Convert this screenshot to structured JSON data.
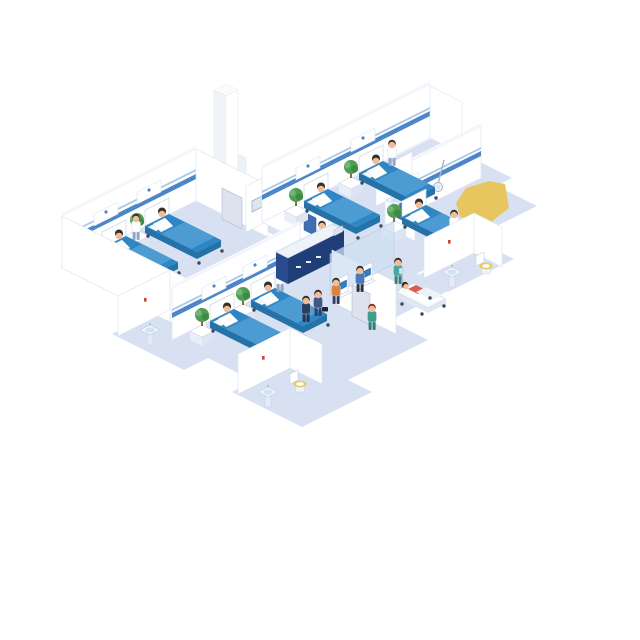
{
  "scene": {
    "description": "Isometric cutaway illustration of a hospital ward floor: four patient rooms with blue beds and seated patients, en-suite bathrooms with sinks and toilets, a central navy reception desk with receptionist and wall monitors, two self check-in kiosks behind a glass wall, an elevator column, corridor visitors, a walking nurse and an orderly pushing a stretcher with a patient; a yellow highlight blob sits over the right single-bed room.",
    "width": 640,
    "height": 640,
    "background": "#ffffff"
  },
  "palette": {
    "floor": "#d8e1f1",
    "wall": "#ffffff",
    "wallShade": "#edf1f8",
    "wallEdge": "#dde4f0",
    "wallTop": "#f4f7fb",
    "stripe": "#4c86c8",
    "stripeLight": "#a9c7e8",
    "bedTop": "#2e86c4",
    "bedSide": "#2472a8",
    "blanket": "#4d9bd3",
    "pillow": "#f6f9fc",
    "caster": "#3f4854",
    "skin": "#f0bd9a",
    "hair": "#3a2f28",
    "glass": "#cfe0f2",
    "screenBlue": "#2f7fc1",
    "screenGrey": "#dde5f0",
    "desk": "#1f3e78",
    "deskSide": "#2a4c8e",
    "deskTop": "#eef3fa",
    "plant": "#4f9e53",
    "plantLight": "#6fb873",
    "plantDark": "#3c8a44",
    "trunk": "#8a6b4a",
    "doorGrey": "#dce3ef",
    "doorBlue": "#3f6fae",
    "signRed": "#c4453c",
    "toiletSeat": "#e8c95c",
    "sinkBowl": "#cfe3f4",
    "metal": "#a7b4c6",
    "yellowHighlight": "#e7c65f",
    "coatWhite": "#fdfefe",
    "scrubTeal": "#45a79d",
    "scrubGreen": "#3f9e8f",
    "navy": "#2b3f63",
    "steelBlue": "#4a79b8",
    "orange": "#e0823f",
    "red": "#d85c4d"
  },
  "inventory": {
    "patient_rooms": [
      {
        "id": "room-top-right",
        "beds": 2,
        "staff": "nurse"
      },
      {
        "id": "room-right-single",
        "beds": 1,
        "staff": "doctor",
        "equipment": "overhead-exam-light"
      },
      {
        "id": "room-left",
        "beds": 2,
        "staff": "nurse"
      },
      {
        "id": "room-bottom",
        "beds": 2,
        "staff": "nurse"
      }
    ],
    "bathrooms": 4,
    "reception": {
      "desk": 1,
      "receptionist": 1,
      "wall_monitors": 3,
      "checkin_kiosks": 2,
      "kiosk_users": 2
    },
    "elevator": {
      "count": 1,
      "passenger": 1
    },
    "corridor": {
      "visitors": 2,
      "walking_nurse": 1,
      "stretcher": 1,
      "stretcher_orderly": 1,
      "stretcher_patient": 1
    },
    "highlight": {
      "shape": "yellow-blob",
      "location": "over right single-bed room"
    }
  }
}
